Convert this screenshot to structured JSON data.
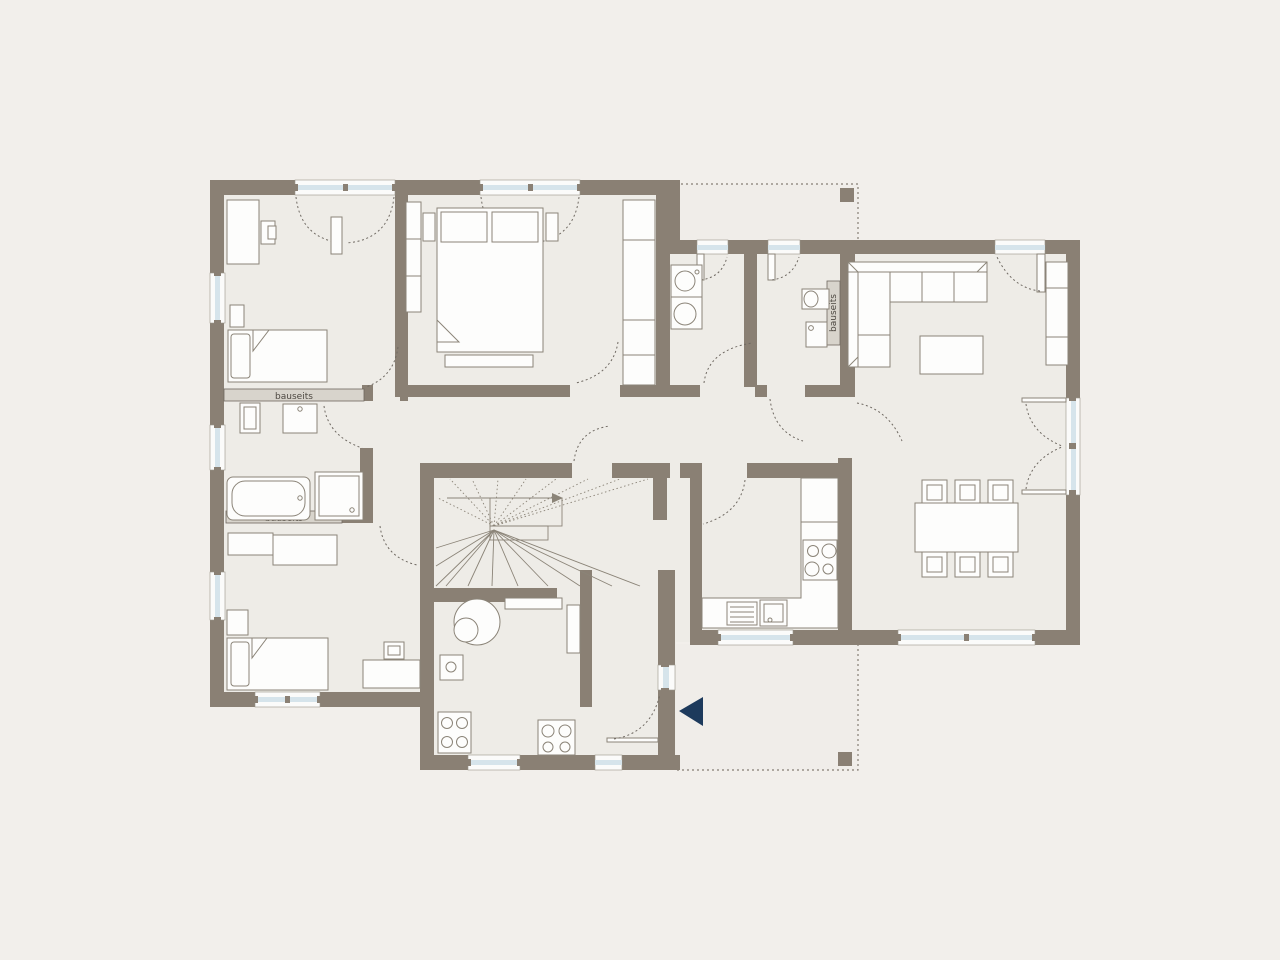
{
  "labels": {
    "bauseits_bathroom_top": "bauseits",
    "bauseits_bathroom_bottom": "bauseits",
    "bauseits_wc": "bauseits"
  },
  "colors": {
    "background": "#f2efeb",
    "floor": "#eeece7",
    "wall": "#8a8074",
    "furniture_outline": "#8b8478",
    "window_glass": "#d6e4eb",
    "bauseits_bar": "#d8d4cc",
    "door_swing_dash": "#6f6962",
    "entrance_arrow_navy": "#1d3a5c"
  },
  "symbols": {
    "entrance_arrow": "left-pointing-triangle",
    "terrace_post": "small-square",
    "stair_direction": "right-pointing-arrow"
  }
}
